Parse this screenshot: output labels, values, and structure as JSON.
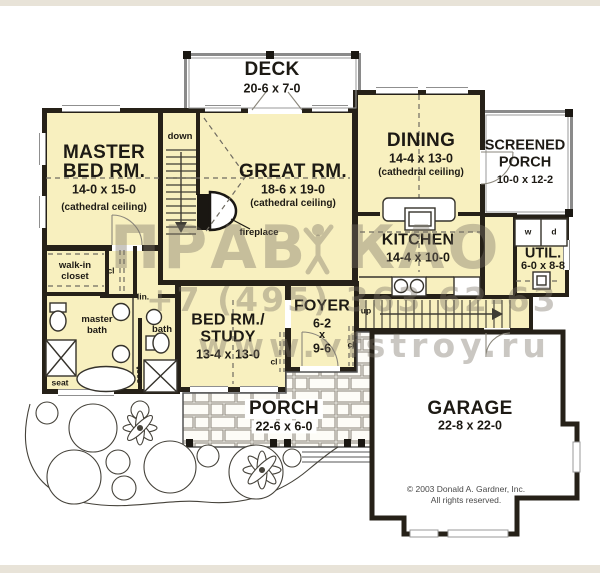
{
  "plan": {
    "rooms": {
      "deck": {
        "name": "DECK",
        "dims": "20-6 x 7-0"
      },
      "master_bed": {
        "line1": "MASTER",
        "line2": "BED RM.",
        "dims": "14-0 x 15-0",
        "note": "(cathedral ceiling)"
      },
      "great": {
        "name": "GREAT RM.",
        "dims": "18-6 x 19-0",
        "note": "(cathedral ceiling)"
      },
      "dining": {
        "name": "DINING",
        "dims": "14-4 x 13-0",
        "note": "(cathedral ceiling)"
      },
      "screened_porch": {
        "line1": "SCREENED",
        "line2": "PORCH",
        "dims": "10-0 x 12-2"
      },
      "kitchen": {
        "name": "KITCHEN",
        "dims": "14-4 x 10-0"
      },
      "utility": {
        "name": "UTIL.",
        "dims": "6-0 x 8-8",
        "washer": "w",
        "dryer": "d"
      },
      "foyer": {
        "name": "FOYER",
        "dim1": "6-2",
        "by": "x",
        "dim2": "9-6"
      },
      "bed_study": {
        "line1": "BED RM./",
        "line2": "STUDY",
        "dims": "13-4 x 13-0"
      },
      "porch": {
        "name": "PORCH",
        "dims": "22-6 x 6-0"
      },
      "garage": {
        "name": "GARAGE",
        "dims": "22-8 x 22-0"
      }
    },
    "annotations": {
      "down": "down",
      "up": "up",
      "fireplace": "fireplace",
      "walk_in_1": "walk-in",
      "walk_in_2": "closet",
      "master_bath_1": "master",
      "master_bath_2": "bath",
      "bath": "bath",
      "linen": "lin.",
      "closet_abbr": "cl",
      "seat": "seat"
    },
    "copyright": {
      "line1": "© 2003 Donald A. Gardner, Inc.",
      "line2": "All rights reserved."
    },
    "watermark": {
      "word1": "ПРАВ",
      "word2": "КАО",
      "phone": "+7 (495) 363 62-63",
      "website": "www.vfstroy.ru"
    },
    "colors": {
      "floor": "#f8f0bf",
      "wall": "#262118",
      "outdoor": "#ffffff",
      "scan_border": "#e8e3d8",
      "watermark_gray": "#7a7467"
    }
  }
}
